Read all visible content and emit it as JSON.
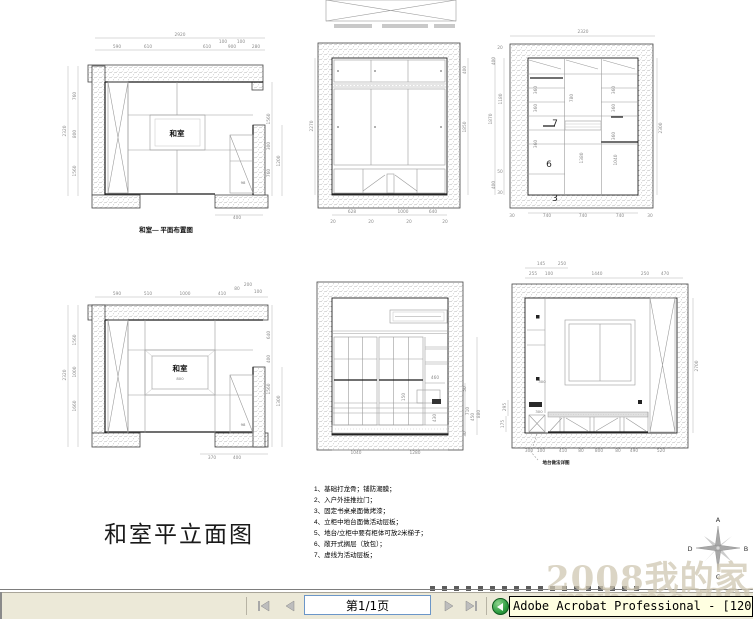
{
  "colors": {
    "bar_bg": "#ece9d8",
    "tooltip_bg": "#ffffe1",
    "page_box_border": "#6b96c8",
    "icon_green": "#2f9e42",
    "watermark": "#cfc7b2",
    "dim_text": "#8c8c8c",
    "wall_stroke": "#444444"
  },
  "sheet": {
    "title": "和室平立面图"
  },
  "plan": {
    "caption": "和室— 平面布置图",
    "room_label": "和室",
    "cabinet_label": "98",
    "total_width": "2920",
    "top_dims": [
      "590",
      "610",
      "610",
      "100",
      "900",
      "100",
      "280"
    ],
    "total_height": "2320",
    "left_dims": [
      "760",
      "800",
      "1560"
    ],
    "right_dims": [
      "1560",
      "300",
      "760"
    ],
    "right_inner_dim": "1200",
    "bottom_dim": "400"
  },
  "wardrobe": {
    "left_dim": "2270",
    "right_dims": [
      "400",
      "1850"
    ],
    "bottom_dims": [
      "628",
      "1000",
      "640"
    ],
    "bottom_small_dims": [
      "20",
      "20",
      "20",
      "20"
    ]
  },
  "shelf": {
    "top_dim": "2320",
    "right_dim": "2300",
    "left_dims": [
      "20",
      "400",
      "1180",
      "1870",
      "50",
      "400",
      "30"
    ],
    "bottom_dims": [
      "30",
      "740",
      "740",
      "740",
      "30"
    ],
    "inner_dims": [
      "360",
      "360",
      "360",
      "780",
      "360",
      "360",
      "360",
      "1380",
      "1040"
    ],
    "numbers": [
      "7",
      "6",
      "3"
    ]
  },
  "ceiling": {
    "room_label": "和室",
    "center_dim": "800",
    "cabinet_label": "98",
    "top_dims": [
      "590",
      "510",
      "1000",
      "410",
      "80",
      "200",
      "100"
    ],
    "total_height": "2320",
    "left_dims": [
      "1560",
      "1000",
      "1660"
    ],
    "right_dims": [
      "640",
      "400",
      "1560",
      "1300"
    ],
    "bottom_dims": [
      "370",
      "400"
    ]
  },
  "shoji": {
    "mid_dim": "460",
    "inner_dims": [
      "150",
      "430"
    ],
    "right_dims": [
      "50",
      "710",
      "450",
      "880",
      "30"
    ],
    "bottom_dims": [
      "1040",
      "1280"
    ]
  },
  "window_elev": {
    "top_dims_upper": [
      "145",
      "250"
    ],
    "top_dims_lower": [
      "255",
      "100",
      "1440",
      "250",
      "470"
    ],
    "right_dim": "2700",
    "left_dims": [
      "295",
      "175"
    ],
    "inner_dims": [
      "300",
      "300"
    ],
    "bottom_dims": [
      "300",
      "100",
      "410",
      "80",
      "800",
      "80",
      "490",
      "520"
    ],
    "callout": "地台做法详图"
  },
  "notes": {
    "items": [
      "1、基础打龙骨；铺防潮膜；",
      "2、入户外挂推拉门；",
      "3、固定书桌桌面做烤漆；",
      "4、立柜中地台面做活动层板；",
      "5、地台/立柜中要有柜体可放2米梯子；",
      "6、敞开式搁层（放包）；",
      "7、虚线为活动层板；"
    ]
  },
  "compass": {
    "north": "A",
    "east": "B",
    "south": "C",
    "west": "D"
  },
  "watermark": {
    "line1": "2008我的家",
    "line2": "myhome2008.com"
  },
  "statusbar": {
    "page_indicator": "第1/1页",
    "taskbar_label": "Adobe Acrobat Professional - [1205"
  }
}
